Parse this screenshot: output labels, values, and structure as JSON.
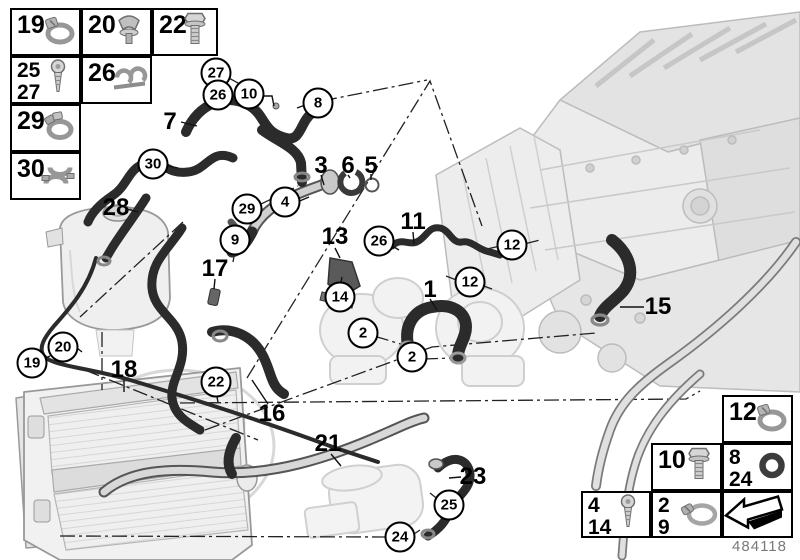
{
  "part_number": "484118",
  "colors": {
    "hose_dark": "#2b2b2b",
    "line": "#111111",
    "engine_ghost": "#e8e8e8",
    "metal": "#cfcfcf"
  },
  "legend_top_left": [
    {
      "labels": [
        "19"
      ],
      "icon": "hose-clamp-icon",
      "x": 10,
      "y": 8,
      "w": 71,
      "h": 48
    },
    {
      "labels": [
        "20"
      ],
      "icon": "expanding-clip-icon",
      "x": 81,
      "y": 8,
      "w": 71,
      "h": 48
    },
    {
      "labels": [
        "22"
      ],
      "icon": "bolt-icon",
      "x": 152,
      "y": 8,
      "w": 66,
      "h": 48
    },
    {
      "labels": [
        "25",
        "27"
      ],
      "icon": "screw-icon",
      "x": 10,
      "y": 56,
      "w": 71,
      "h": 48
    },
    {
      "labels": [
        "26"
      ],
      "icon": "holder-clip-icon",
      "x": 81,
      "y": 56,
      "w": 71,
      "h": 48
    },
    {
      "labels": [
        "29"
      ],
      "icon": "spring-clamp-icon",
      "x": 10,
      "y": 104,
      "w": 71,
      "h": 48
    },
    {
      "labels": [
        "30"
      ],
      "icon": "bracket-clamp-icon",
      "x": 10,
      "y": 152,
      "w": 71,
      "h": 48
    }
  ],
  "legend_bottom_right": [
    {
      "labels": [
        "12"
      ],
      "icon": "hose-clamp-icon",
      "x": 722,
      "y": 395,
      "w": 71,
      "h": 48
    },
    {
      "labels": [
        "10"
      ],
      "icon": "bolt-icon",
      "x": 651,
      "y": 443,
      "w": 71,
      "h": 48
    },
    {
      "labels": [
        "8",
        "24"
      ],
      "icon": "o-ring-icon",
      "x": 722,
      "y": 443,
      "w": 71,
      "h": 48
    },
    {
      "labels": [
        "4",
        "14"
      ],
      "icon": "screw-icon",
      "x": 581,
      "y": 491,
      "w": 70,
      "h": 47
    },
    {
      "labels": [
        "2",
        "9"
      ],
      "icon": "worm-clamp-icon",
      "x": 651,
      "y": 491,
      "w": 71,
      "h": 47
    },
    {
      "labels": [],
      "icon": "direction-arrow-icon",
      "x": 722,
      "y": 491,
      "w": 71,
      "h": 47
    }
  ],
  "callouts": [
    {
      "label": "27",
      "style": "circled",
      "x": 216,
      "y": 73
    },
    {
      "label": "26",
      "style": "circled",
      "x": 218,
      "y": 95
    },
    {
      "label": "10",
      "style": "circled",
      "x": 249,
      "y": 94
    },
    {
      "label": "8",
      "style": "circled",
      "x": 318,
      "y": 103
    },
    {
      "label": "7",
      "style": "plain",
      "x": 170,
      "y": 122
    },
    {
      "label": "30",
      "style": "circled",
      "x": 153,
      "y": 164
    },
    {
      "label": "3",
      "style": "plain",
      "x": 321,
      "y": 166
    },
    {
      "label": "6",
      "style": "plain",
      "x": 348,
      "y": 166
    },
    {
      "label": "5",
      "style": "plain",
      "x": 371,
      "y": 166
    },
    {
      "label": "4",
      "style": "circled",
      "x": 285,
      "y": 202
    },
    {
      "label": "29",
      "style": "circled",
      "x": 247,
      "y": 209
    },
    {
      "label": "28",
      "style": "plain",
      "x": 116,
      "y": 208
    },
    {
      "label": "11",
      "style": "plain",
      "x": 413,
      "y": 222
    },
    {
      "label": "13",
      "style": "plain",
      "x": 335,
      "y": 237
    },
    {
      "label": "9",
      "style": "circled",
      "x": 235,
      "y": 240
    },
    {
      "label": "26",
      "style": "circled",
      "x": 379,
      "y": 241
    },
    {
      "label": "12",
      "style": "circled",
      "x": 512,
      "y": 245
    },
    {
      "label": "17",
      "style": "plain",
      "x": 215,
      "y": 269
    },
    {
      "label": "12",
      "style": "circled",
      "x": 470,
      "y": 282
    },
    {
      "label": "1",
      "style": "plain",
      "x": 430,
      "y": 290
    },
    {
      "label": "14",
      "style": "circled",
      "x": 340,
      "y": 297
    },
    {
      "label": "15",
      "style": "plain",
      "x": 658,
      "y": 307
    },
    {
      "label": "2",
      "style": "circled",
      "x": 363,
      "y": 333
    },
    {
      "label": "20",
      "style": "circled",
      "x": 63,
      "y": 347
    },
    {
      "label": "2",
      "style": "circled",
      "x": 412,
      "y": 357
    },
    {
      "label": "19",
      "style": "circled",
      "x": 32,
      "y": 363
    },
    {
      "label": "18",
      "style": "plain",
      "x": 124,
      "y": 370
    },
    {
      "label": "22",
      "style": "circled",
      "x": 216,
      "y": 382
    },
    {
      "label": "16",
      "style": "plain",
      "x": 272,
      "y": 414
    },
    {
      "label": "21",
      "style": "plain",
      "x": 328,
      "y": 444
    },
    {
      "label": "23",
      "style": "plain",
      "x": 473,
      "y": 477
    },
    {
      "label": "25",
      "style": "circled",
      "x": 449,
      "y": 505
    },
    {
      "label": "24",
      "style": "circled",
      "x": 400,
      "y": 537
    }
  ]
}
